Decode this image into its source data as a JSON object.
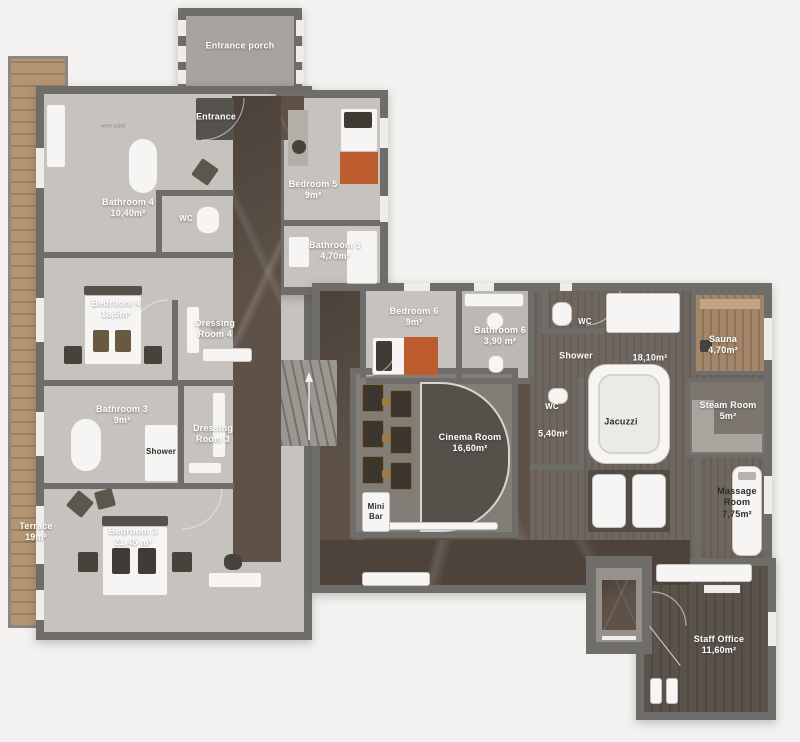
{
  "title": "Chalet lower floor plan",
  "colors": {
    "background": "#f3f2f0",
    "wall": "#6f6d6a",
    "floor_light": "#c6c2bd",
    "marble": "#5e5248",
    "marble_dark": "#4e433b",
    "spa_wood": "#6b635c",
    "terrace_wood": "#b29273",
    "sauna_wood": "#a08366",
    "office_wood": "#56504a",
    "accent_bed_orange": "#bd5c2e",
    "label_light": "#ffffff",
    "label_dark": "#2e2b28"
  },
  "rooms": {
    "entrance_porch": {
      "label": "Entrance porch"
    },
    "entrance": {
      "label": "Entrance"
    },
    "note": {
      "label": "verre sablé"
    },
    "bathroom4": {
      "label": "Bathroom 4",
      "area": "10,40m²"
    },
    "wc4": {
      "label": "WC"
    },
    "bedroom5": {
      "label": "Bedroom 5",
      "area": "9m²"
    },
    "bathroom5": {
      "label": "Bathroom 5",
      "area": "4,70m²"
    },
    "bedroom4": {
      "label": "Bedroom 4",
      "area": "18,5m²"
    },
    "dressing4": {
      "label": "Dressing Room 4"
    },
    "bathroom3": {
      "label": "Bathroom 3",
      "area": "9m²"
    },
    "dressing3": {
      "label": "Dressing Room 3"
    },
    "shower3": {
      "label": "Shower"
    },
    "terrace": {
      "label": "Terrace",
      "area": "19m²"
    },
    "bedroom3": {
      "label": "Bedroom 3",
      "area": "21,45 m²"
    },
    "bedroom6": {
      "label": "Bedroom 6",
      "area": "9m²"
    },
    "bathroom6": {
      "label": "Bathroom 6",
      "area": "3,90 m²"
    },
    "wc_spa_top": {
      "label": "WC"
    },
    "shower_spa": {
      "label": "Shower"
    },
    "hammam": {
      "area": "18,10m²"
    },
    "sauna": {
      "label": "Sauna",
      "area": "4,70m²"
    },
    "cinema": {
      "label": "Cinema Room",
      "area": "16,60m²"
    },
    "wc_spa": {
      "label": "WC"
    },
    "small_room": {
      "area": "5,40m²"
    },
    "jacuzzi": {
      "label": "Jacuzzi"
    },
    "steam_room": {
      "label": "Steam Room",
      "area": "5m²"
    },
    "massage_room": {
      "label": "Massage Room",
      "area": "7,75m²"
    },
    "mini_bar": {
      "label": "Mini Bar"
    },
    "staff_office": {
      "label": "Staff Office",
      "area": "11,60m²"
    }
  }
}
